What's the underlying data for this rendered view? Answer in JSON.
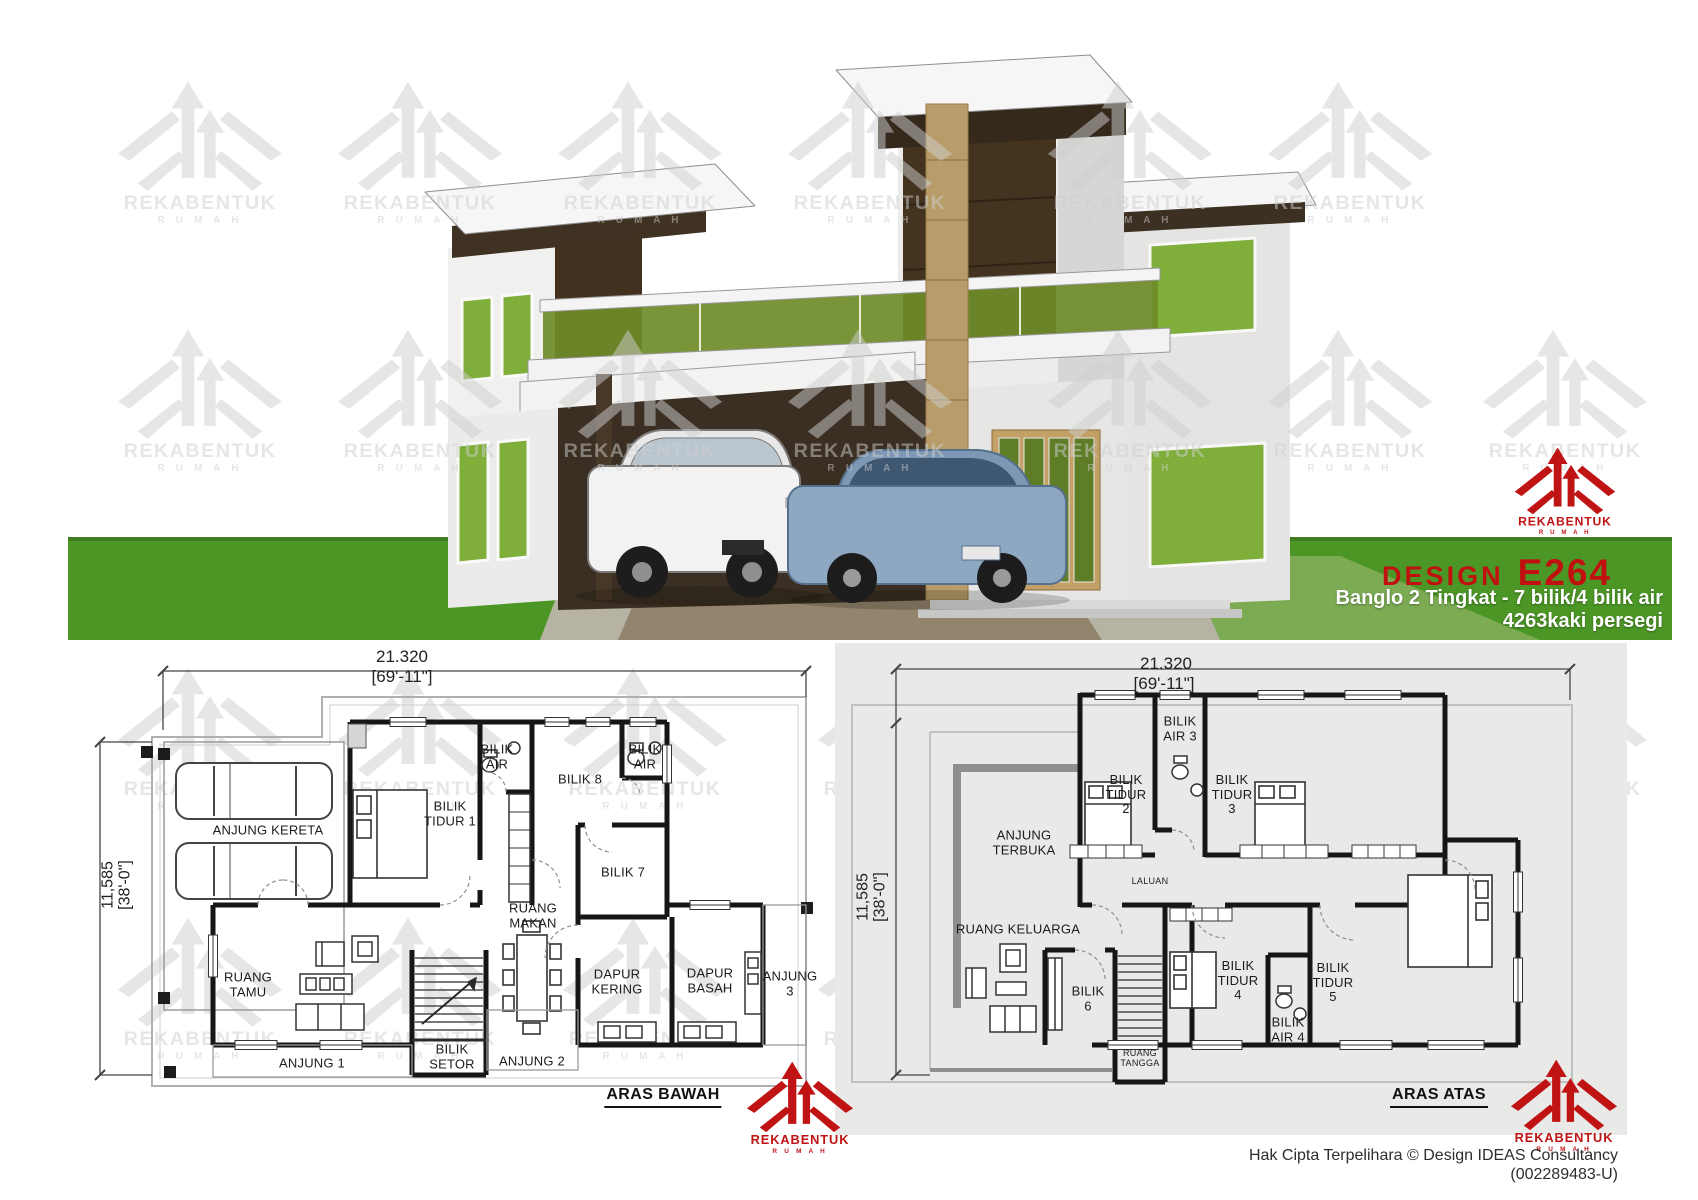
{
  "branding": {
    "logo_text": "REKABENTUK",
    "logo_subtext": "R U M A H",
    "accent_red": "#c01414",
    "watermark_gray": "#cfcfcf"
  },
  "design_info": {
    "design_label": "DESIGN",
    "design_code": "E264",
    "subtitle": "Banglo 2 Tingkat - 7 bilik/4 bilik air",
    "area": "4263kaki persegi"
  },
  "render": {
    "grass_green": "#4c9626",
    "glass_green": "#6f8b28",
    "window_green": "#7fae3a",
    "panel_brown": "#41311e",
    "pillar_tan": "#b89d6a"
  },
  "ground_floor": {
    "title": "ARAS BAWAH",
    "width_dim": "21.320",
    "width_dim_ft": "[69'-11\"]",
    "depth_dim": "11,585",
    "depth_dim_ft": "[38'-0\"]",
    "rooms": [
      "ANJUNG KERETA",
      "BILIK TIDUR 1",
      "BILIK AIR",
      "BILIK 8",
      "BILIK AIR",
      "BILIK 7",
      "RUANG MAKAN",
      "RUANG TAMU",
      "ANJUNG 1",
      "BILIK SETOR",
      "ANJUNG 2",
      "DAPUR KERING",
      "DAPUR BASAH",
      "ANJUNG 3"
    ]
  },
  "upper_floor": {
    "title": "ARAS ATAS",
    "width_dim": "21.320",
    "width_dim_ft": "[69'-11\"]",
    "depth_dim": "11,585",
    "depth_dim_ft": "[38'-0\"]",
    "rooms": [
      "ANJUNG TERBUKA",
      "BILIK TIDUR 2",
      "BILIK AIR 3",
      "BILIK TIDUR 3",
      "LALUAN",
      "RUANG KELUARGA",
      "BILIK 6",
      "RUANG TANGGA",
      "BILIK TIDUR 4",
      "BILIK AIR 4",
      "BILIK TIDUR 5"
    ]
  },
  "footer": {
    "copyright": "Hak Cipta Terpelihara  © Design IDEAS Consultancy",
    "registration": "(002289483-U)"
  }
}
